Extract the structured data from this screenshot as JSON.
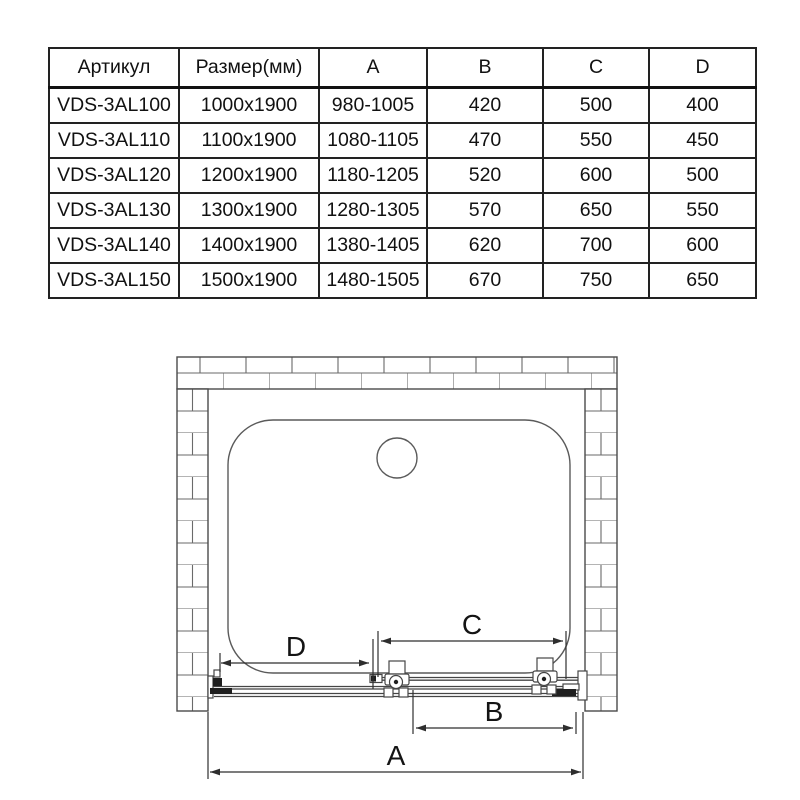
{
  "table": {
    "headers": [
      "Артикул",
      "Размер(мм)",
      "A",
      "B",
      "C",
      "D"
    ],
    "rows": [
      [
        "VDS-3AL100",
        "1000x1900",
        "980-1005",
        "420",
        "500",
        "400"
      ],
      [
        "VDS-3AL110",
        "1100x1900",
        "1080-1105",
        "470",
        "550",
        "450"
      ],
      [
        "VDS-3AL120",
        "1200x1900",
        "1180-1205",
        "520",
        "600",
        "500"
      ],
      [
        "VDS-3AL130",
        "1300x1900",
        "1280-1305",
        "570",
        "650",
        "550"
      ],
      [
        "VDS-3AL140",
        "1400x1900",
        "1380-1405",
        "620",
        "700",
        "600"
      ],
      [
        "VDS-3AL150",
        "1500x1900",
        "1480-1505",
        "670",
        "750",
        "650"
      ]
    ]
  },
  "diagram": {
    "description": "Top view installation drawing of sliding shower door in alcove with brick walls, shower tray and drain",
    "dimension_labels": {
      "a": "A",
      "b": "B",
      "c": "C",
      "d": "D"
    }
  },
  "colors": {
    "background": "#ffffff",
    "table_border": "#222222",
    "line_work": "#454545",
    "dimension": "#2e2e2e",
    "text": "#111111"
  }
}
